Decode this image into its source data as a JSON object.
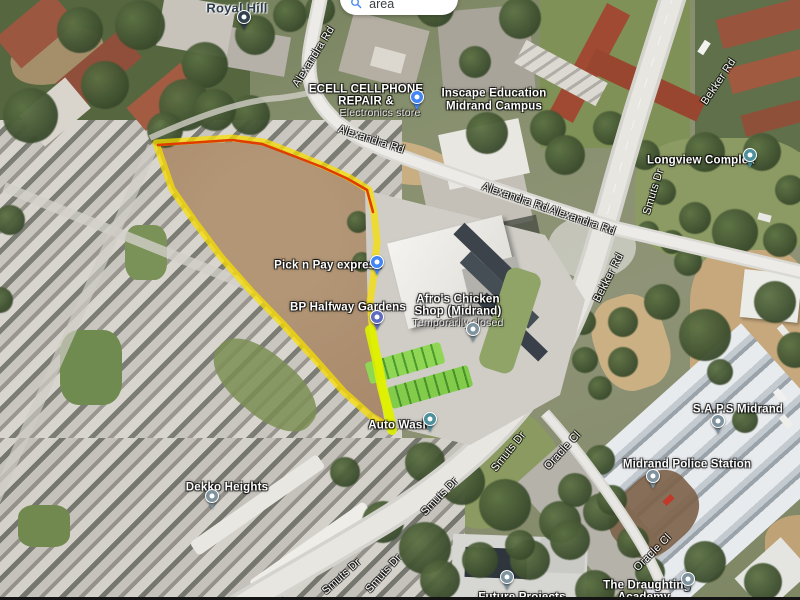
{
  "map": {
    "search_button": {
      "label": "Search this area"
    },
    "highlight": {
      "description": "vacant-plot-boundary",
      "outline_color": "#f5dc00",
      "top_edge_color": "#e03c00",
      "bottom_edge_color": "#d8ee00"
    },
    "labels": [
      {
        "id": "royal-hill",
        "text": "Royal Hill",
        "x": 237,
        "y": 8,
        "rot": 0,
        "cls": "dark"
      },
      {
        "id": "alexandra-rd-a",
        "text": "Alexandra Rd",
        "x": 314,
        "y": 57,
        "rot": -58,
        "cls": "road"
      },
      {
        "id": "ecell-name-1",
        "text": "ECELL CELLPHONE",
        "x": 366,
        "y": 90,
        "rot": 0,
        "cls": "poi"
      },
      {
        "id": "ecell-name-2",
        "text": "REPAIR &",
        "x": 366,
        "y": 102,
        "rot": 0,
        "cls": "poi"
      },
      {
        "id": "ecell-subtitle",
        "text": "Electronics store",
        "x": 380,
        "y": 113,
        "rot": 0,
        "cls": "poi-sub"
      },
      {
        "id": "inscape-name-1",
        "text": "Inscape Education",
        "x": 494,
        "y": 94,
        "rot": 0,
        "cls": "poi"
      },
      {
        "id": "inscape-name-2",
        "text": "Midrand Campus",
        "x": 494,
        "y": 107,
        "rot": 0,
        "cls": "poi"
      },
      {
        "id": "alexandra-rd-b",
        "text": "Alexandra Rd",
        "x": 371,
        "y": 140,
        "rot": 18,
        "cls": "road"
      },
      {
        "id": "alexandra-rd-c",
        "text": "Alexandra Rd",
        "x": 515,
        "y": 198,
        "rot": 19,
        "cls": "road"
      },
      {
        "id": "alexandra-rd-d",
        "text": "Alexandra Rd",
        "x": 582,
        "y": 221,
        "rot": 19,
        "cls": "road"
      },
      {
        "id": "bekker-rd-a",
        "text": "Bekker Rd",
        "x": 719,
        "y": 82,
        "rot": -56,
        "cls": "road"
      },
      {
        "id": "smuts-dr-a",
        "text": "Smuts Dr",
        "x": 654,
        "y": 192,
        "rot": -73,
        "cls": "road"
      },
      {
        "id": "longview-complex",
        "text": "Longview Complex",
        "x": 701,
        "y": 161,
        "rot": 0,
        "cls": "poi"
      },
      {
        "id": "bekker-rd-b",
        "text": "Bekker Rd",
        "x": 609,
        "y": 278,
        "rot": -63,
        "cls": "road"
      },
      {
        "id": "pick-n-pay",
        "text": "Pick n Pay express",
        "x": 328,
        "y": 266,
        "rot": 0,
        "cls": "poi"
      },
      {
        "id": "bp-halfway",
        "text": "BP Halfway Gardens",
        "x": 348,
        "y": 308,
        "rot": 0,
        "cls": "poi"
      },
      {
        "id": "afros-name-1",
        "text": "Afro's Chicken",
        "x": 458,
        "y": 300,
        "rot": 0,
        "cls": "poi"
      },
      {
        "id": "afros-name-2",
        "text": "Shop (Midrand)",
        "x": 458,
        "y": 312,
        "rot": 0,
        "cls": "poi"
      },
      {
        "id": "afros-status",
        "text": "Temporarily closed",
        "x": 458,
        "y": 323,
        "rot": 0,
        "cls": "poi-sub"
      },
      {
        "id": "auto-wash",
        "text": "Auto Wash",
        "x": 399,
        "y": 426,
        "rot": 0,
        "cls": "poi"
      },
      {
        "id": "smuts-dr-b",
        "text": "Smuts Dr",
        "x": 509,
        "y": 452,
        "rot": -51,
        "cls": "road"
      },
      {
        "id": "oracle-cl-a",
        "text": "Oracle Cl",
        "x": 563,
        "y": 451,
        "rot": -47,
        "cls": "road"
      },
      {
        "id": "smuts-dr-c",
        "text": "Smuts Dr",
        "x": 440,
        "y": 497,
        "rot": -46,
        "cls": "road"
      },
      {
        "id": "dekko-heights",
        "text": "Dekko Heights",
        "x": 227,
        "y": 488,
        "rot": 0,
        "cls": "poi"
      },
      {
        "id": "saps-midrand",
        "text": "S.A.P.S Midrand",
        "x": 738,
        "y": 410,
        "rot": 0,
        "cls": "poi"
      },
      {
        "id": "midrand-police-station",
        "text": "Midrand Police Station",
        "x": 687,
        "y": 465,
        "rot": 0,
        "cls": "poi"
      },
      {
        "id": "smuts-dr-d",
        "text": "Smuts Dr",
        "x": 342,
        "y": 577,
        "rot": -42,
        "cls": "road"
      },
      {
        "id": "smuts-dr-e",
        "text": "Smuts Dr",
        "x": 384,
        "y": 574,
        "rot": -48,
        "cls": "road"
      },
      {
        "id": "oracle-cl-b",
        "text": "Oracle Cl",
        "x": 653,
        "y": 553,
        "rot": -45,
        "cls": "road"
      },
      {
        "id": "draughting-name-1",
        "text": "The Draughting",
        "x": 647,
        "y": 586,
        "rot": 0,
        "cls": "poi"
      },
      {
        "id": "draughting-name-2",
        "text": "Academy",
        "x": 644,
        "y": 598,
        "rot": 0,
        "cls": "poi"
      },
      {
        "id": "future-projects",
        "text": "Future Projects",
        "x": 522,
        "y": 598,
        "rot": 0,
        "cls": "poi"
      }
    ],
    "pins": [
      {
        "id": "royal-hill-pin",
        "icon": "place-pin-icon",
        "x": 244,
        "y": 32,
        "color": "#33424e"
      },
      {
        "id": "ecell-inscape-pin",
        "icon": "shopping-pin-icon",
        "x": 417,
        "y": 112,
        "color": "#4285f4"
      },
      {
        "id": "longview-pin",
        "icon": "complex-pin-icon",
        "x": 750,
        "y": 170,
        "color": "#4e8f9c"
      },
      {
        "id": "pick-n-pay-pin",
        "icon": "grocery-cart-pin-icon",
        "x": 377,
        "y": 277,
        "color": "#4285f4"
      },
      {
        "id": "bp-fuel-pin",
        "icon": "fuel-pin-icon",
        "x": 377,
        "y": 332,
        "color": "#5d6cc0"
      },
      {
        "id": "afros-restaurant-pin",
        "icon": "restaurant-pin-icon",
        "x": 473,
        "y": 344,
        "color": "#7e939e"
      },
      {
        "id": "auto-wash-pin",
        "icon": "car-wash-pin-icon",
        "x": 430,
        "y": 434,
        "color": "#4e8f9c"
      },
      {
        "id": "saps-pin",
        "icon": "police-pin-icon",
        "x": 718,
        "y": 436,
        "color": "#7e939e"
      },
      {
        "id": "police-station-pin",
        "icon": "police-pin-icon",
        "x": 653,
        "y": 491,
        "color": "#7e939e"
      },
      {
        "id": "dekko-heights-pin",
        "icon": "place-pin-icon",
        "x": 212,
        "y": 511,
        "color": "#7e939e"
      },
      {
        "id": "draughting-pin",
        "icon": "school-pin-icon",
        "x": 688,
        "y": 594,
        "color": "#7e939e"
      },
      {
        "id": "future-projects-pin",
        "icon": "place-pin-icon",
        "x": 507,
        "y": 592,
        "color": "#7e939e"
      }
    ]
  }
}
